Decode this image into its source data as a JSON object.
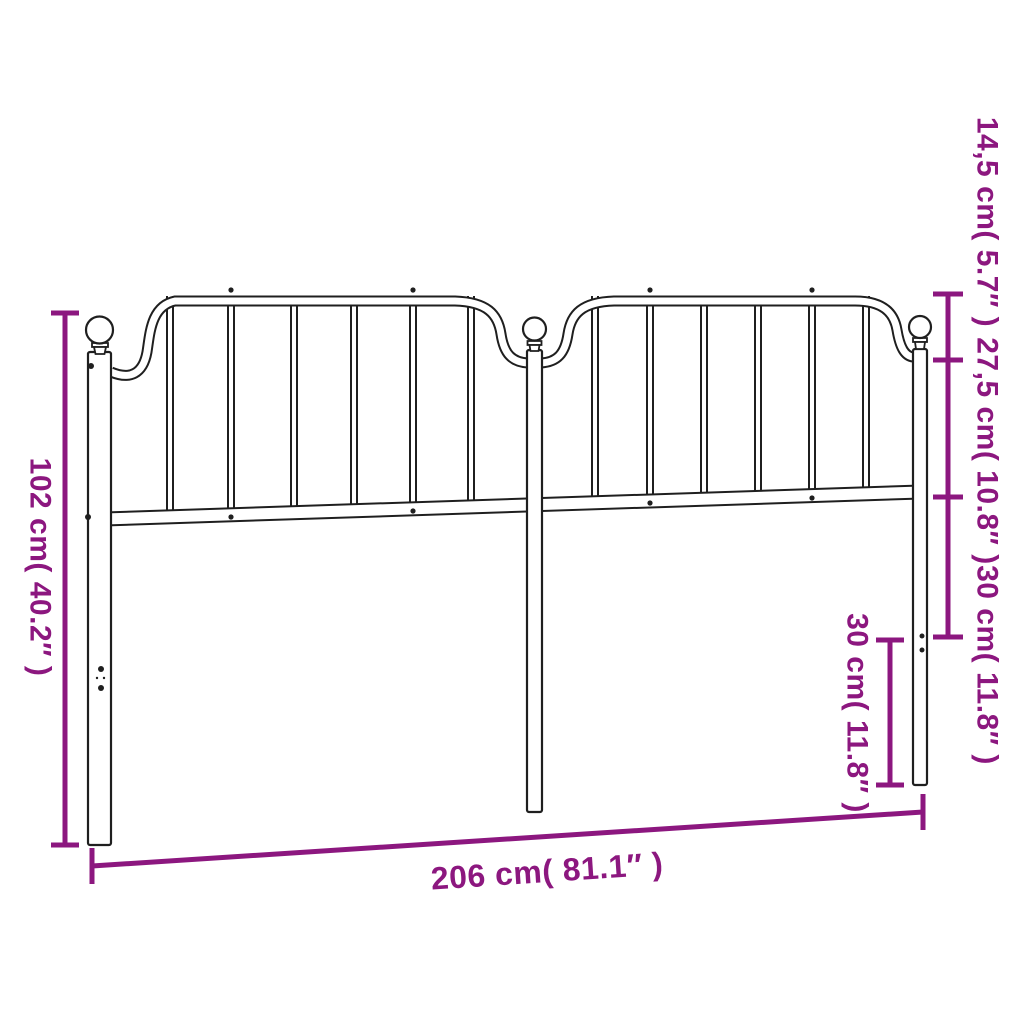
{
  "diagram": {
    "background_color": "#ffffff",
    "outline_color": "#1f1f1f",
    "dimension_color": "#8C177F",
    "dimensions": {
      "height_left": "102 cm( 40.2″ )",
      "width_bottom": "206 cm( 81.1″ )",
      "right_top": "14,5 cm( 5.7″ )",
      "right_middle": "27,5 cm( 10.8″ )",
      "right_bottom": "30 cm( 11.8″ )",
      "inner_right": "30 cm( 11.8″ )"
    }
  }
}
